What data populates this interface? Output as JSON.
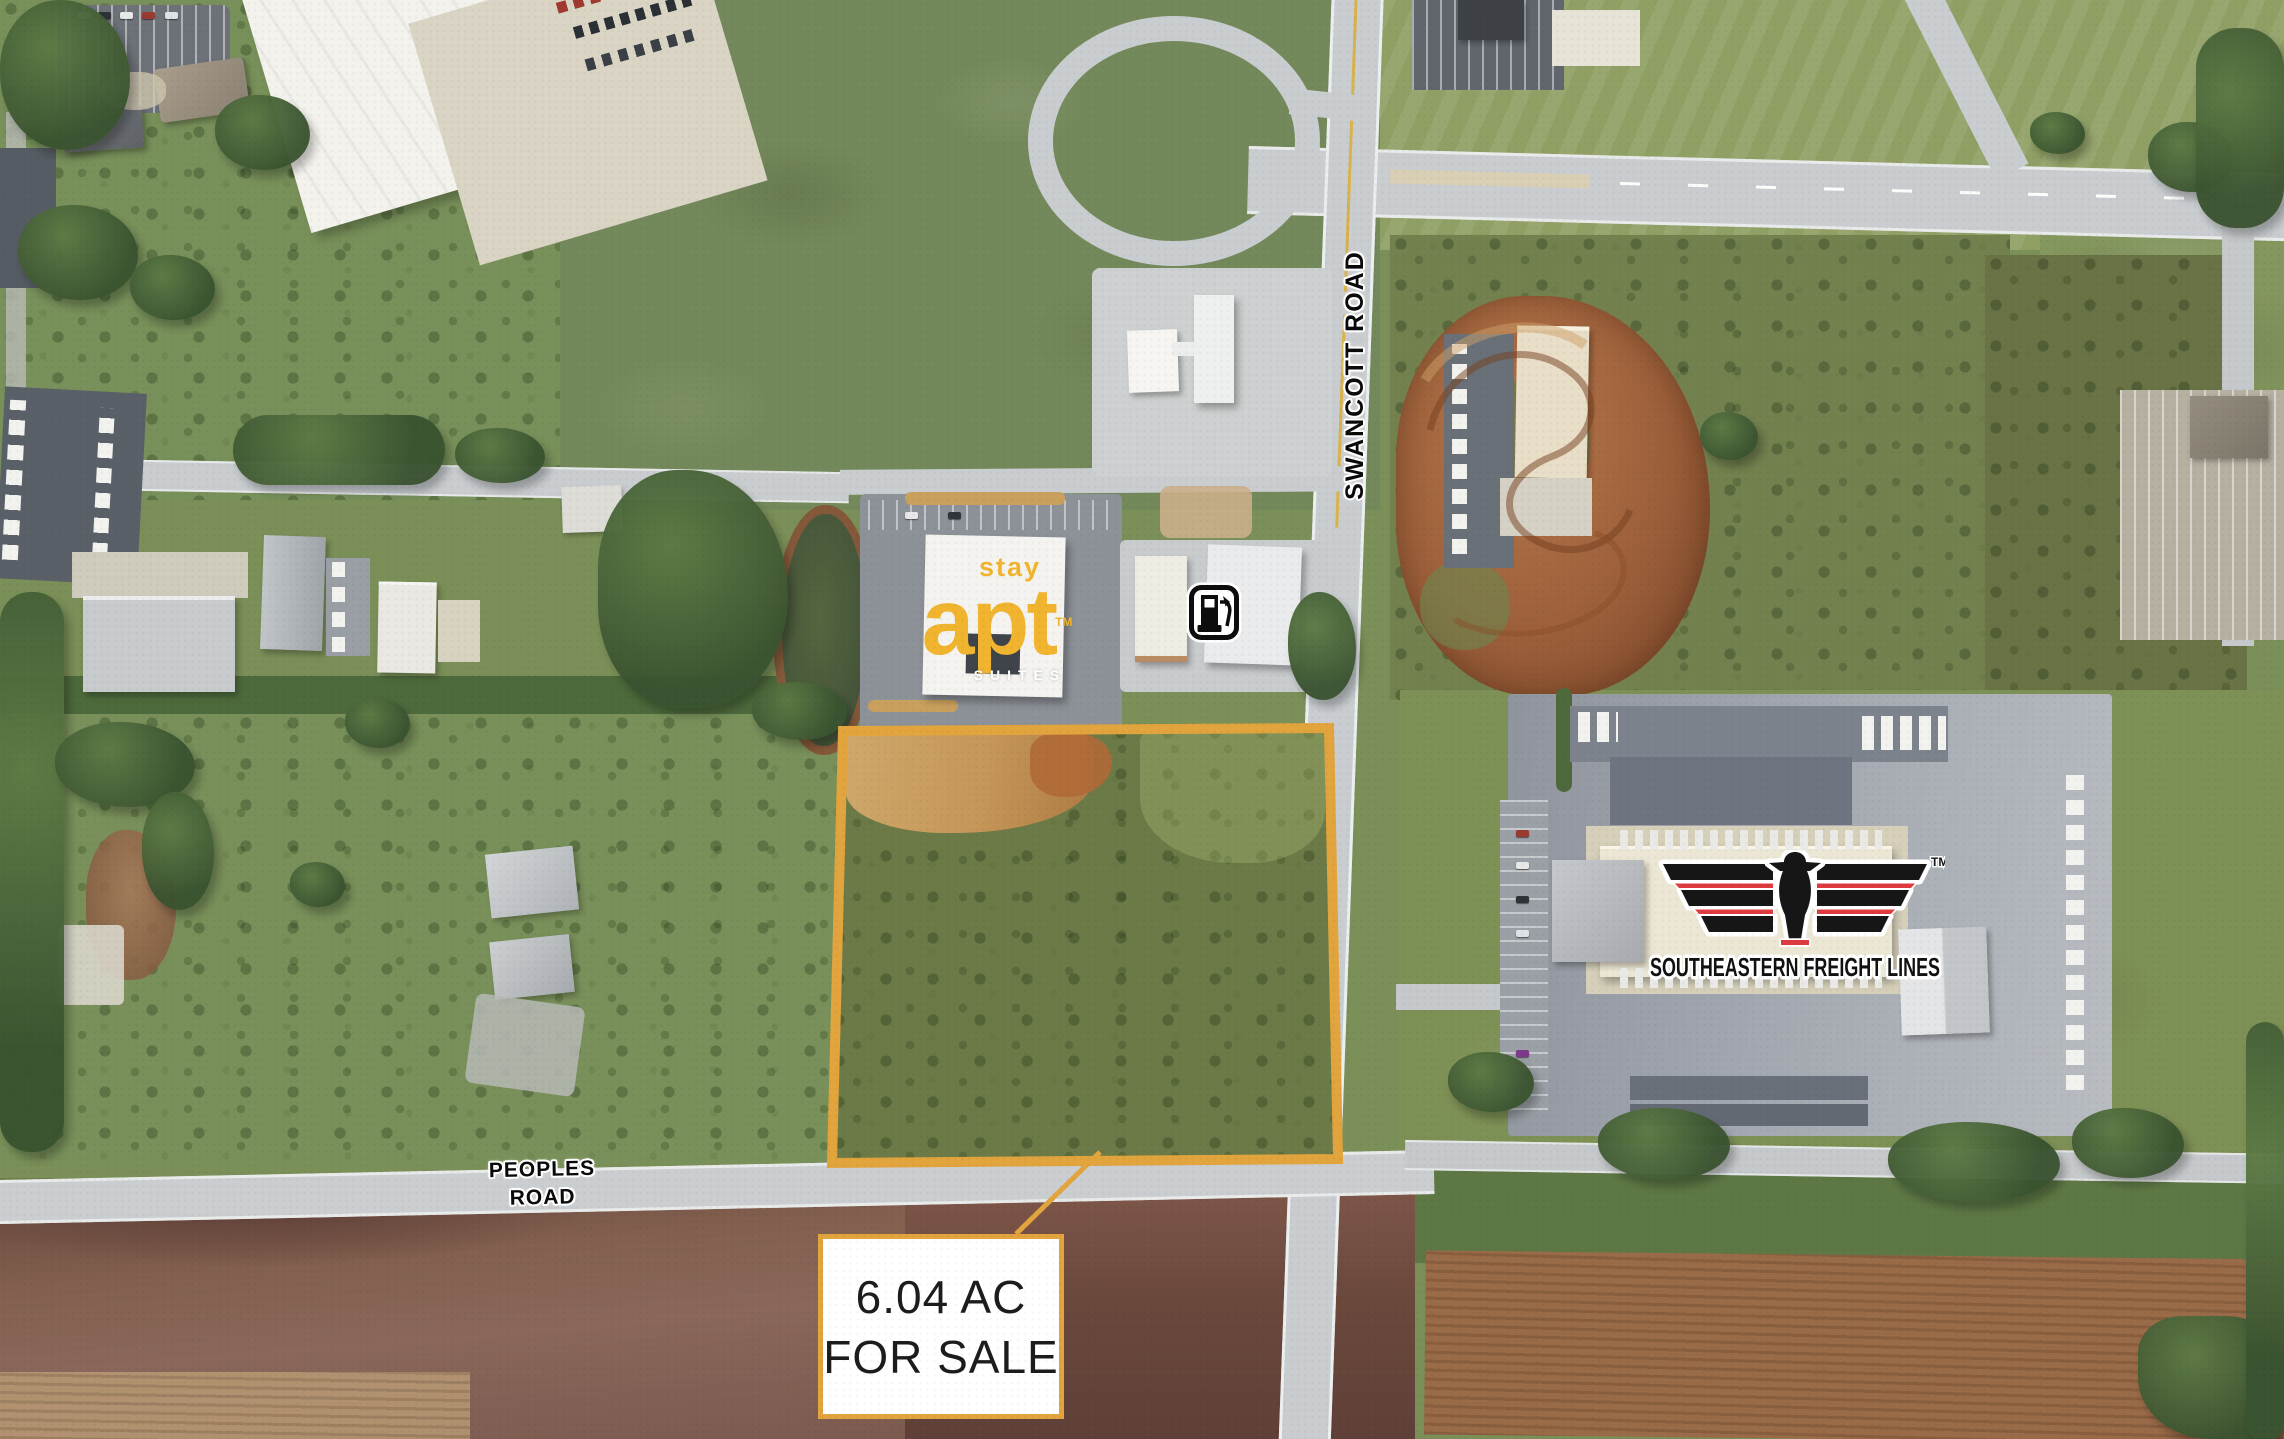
{
  "map": {
    "road_labels": {
      "vertical": "SWANCOTT ROAD",
      "horizontal": "PEOPLES ROAD"
    },
    "parcel_callout": {
      "line1": "6.04 AC",
      "line2": "FOR SALE"
    },
    "logos": {
      "stay_apt": {
        "top": "stay",
        "main": "apt",
        "sub": "SUITES",
        "trademark": "TM"
      },
      "southeastern_freight": {
        "name": "SOUTHEASTERN FREIGHT LINES",
        "trademark": "TM"
      }
    },
    "icons": [
      {
        "name": "fuel-station-icon"
      }
    ],
    "colors": {
      "accent": "#E2A43D",
      "stayAptGold": "#F0B42F",
      "seflRed": "#DE3B40",
      "seflBlack": "#161616"
    }
  }
}
